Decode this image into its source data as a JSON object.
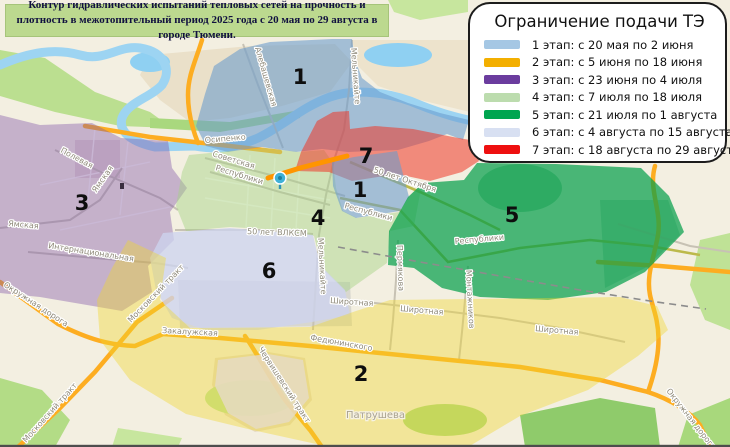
{
  "title": {
    "text": "Контур гидравлических испытаний тепловых сетей на прочность и плотность в межотопительный период 2025 года с 20 мая по 29 августа в городе Тюмени."
  },
  "legend": {
    "title": "Ограничение подачи ТЭ",
    "items": [
      {
        "label": "1 этап: с 20 мая по 2 июня",
        "color": "#A5C7E4"
      },
      {
        "label": "2 этап: с 5 июня по 18 июня",
        "color": "#F3AF00"
      },
      {
        "label": "3 этап: с 23 июня по 4 июля",
        "color": "#6B3C9E"
      },
      {
        "label": "4 этап: с 7 июля по 18 июля",
        "color": "#BCDCAE"
      },
      {
        "label": "5 этап: с 21 июля по 1 августа",
        "color": "#00A550"
      },
      {
        "label": "6 этап: с 4 августа по 15 августа",
        "color": "#D8E0F2"
      },
      {
        "label": "7 этап: с 18 августа по 29 августа",
        "color": "#EE0F0F"
      }
    ]
  },
  "map": {
    "zone_fills": {
      "z1": "rgba(105,155,205,0.58)",
      "z2": "rgba(240,215,45,0.40)",
      "z3": "rgba(128,85,168,0.40)",
      "z4": "rgba(165,210,130,0.45)",
      "z5": "rgba(0,158,72,0.70)",
      "z6": "rgba(205,212,238,0.78)",
      "z7": "rgba(238,55,40,0.55)"
    },
    "zone_labels": [
      {
        "num": "1"
      },
      {
        "num": "7"
      },
      {
        "num": "1"
      },
      {
        "num": "4"
      },
      {
        "num": "5"
      },
      {
        "num": "3"
      },
      {
        "num": "6"
      },
      {
        "num": "2"
      }
    ],
    "street_labels": [
      {
        "text": "Алебашевская"
      },
      {
        "text": "Мельникайте"
      },
      {
        "text": "Осипенко"
      },
      {
        "text": "Советская"
      },
      {
        "text": "Республики"
      },
      {
        "text": "50 лет Октября"
      },
      {
        "text": "Республики"
      },
      {
        "text": "Республики"
      },
      {
        "text": "50 лет ВЛКСМ"
      },
      {
        "text": "Мельникайте"
      },
      {
        "text": "Пермякова"
      },
      {
        "text": "Полевая"
      },
      {
        "text": "Ямская"
      },
      {
        "text": "Ямская"
      },
      {
        "text": "Интернациональная"
      },
      {
        "text": "Московский тракт"
      },
      {
        "text": "Московский тракт"
      },
      {
        "text": "Окружная дорога"
      },
      {
        "text": "Закалужская"
      },
      {
        "text": "Федюнинского"
      },
      {
        "text": "Червишевский тракт"
      },
      {
        "text": "Широтная"
      },
      {
        "text": "Широтная"
      },
      {
        "text": "Широтная"
      },
      {
        "text": "Монтажников"
      },
      {
        "text": "Патрушева"
      },
      {
        "text": "Окружная дорога"
      }
    ]
  }
}
